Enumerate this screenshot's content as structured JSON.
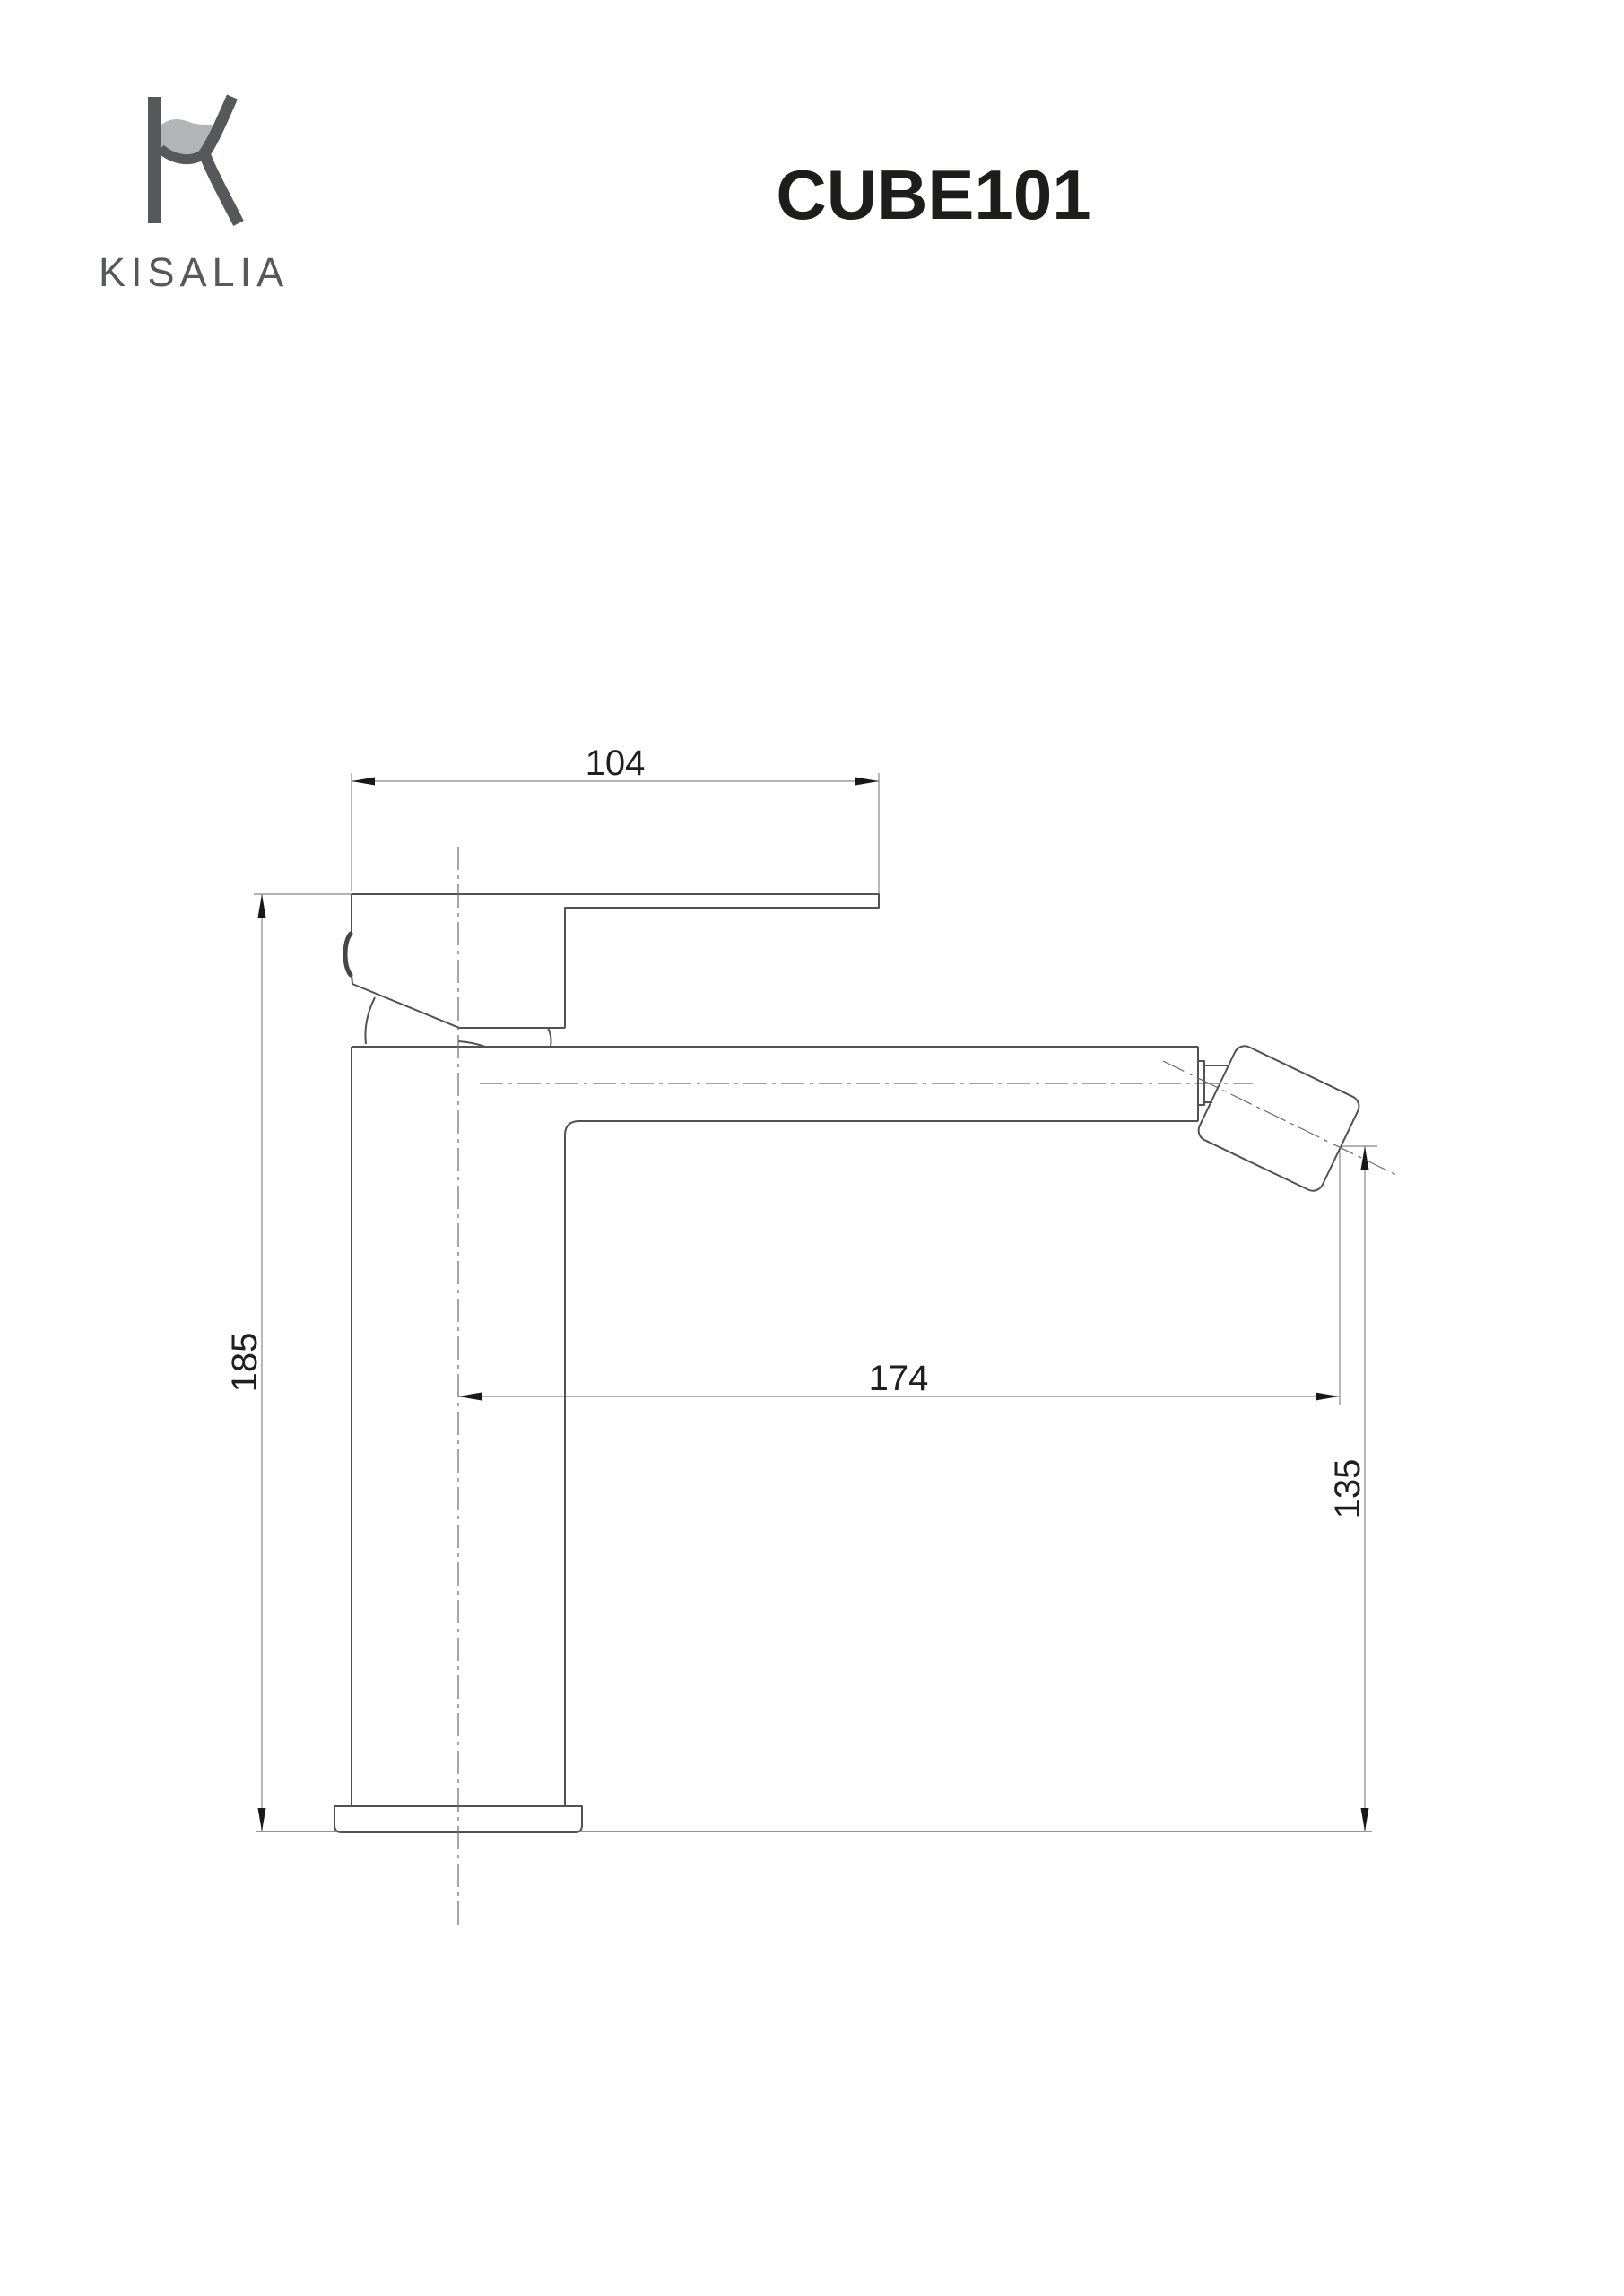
{
  "header": {
    "brand_name": "KISALIA",
    "product_code": "CUBE101"
  },
  "drawing": {
    "type": "technical-dimension-drawing",
    "subject": "single-lever basin mixer tap, side elevation",
    "dimensions": {
      "handle_length_top": "104",
      "total_height": "185",
      "spout_reach": "174",
      "spout_outlet_height": "135"
    }
  },
  "colors": {
    "object_line": "#515256",
    "dimension_line": "#87888b",
    "centerline": "#6a6b6d",
    "text": "#1f1f21",
    "title_text": "#1d1d1b",
    "logo_dark": "#57585a",
    "logo_wave_light": "#b2b4b6",
    "background": "#ffffff"
  }
}
